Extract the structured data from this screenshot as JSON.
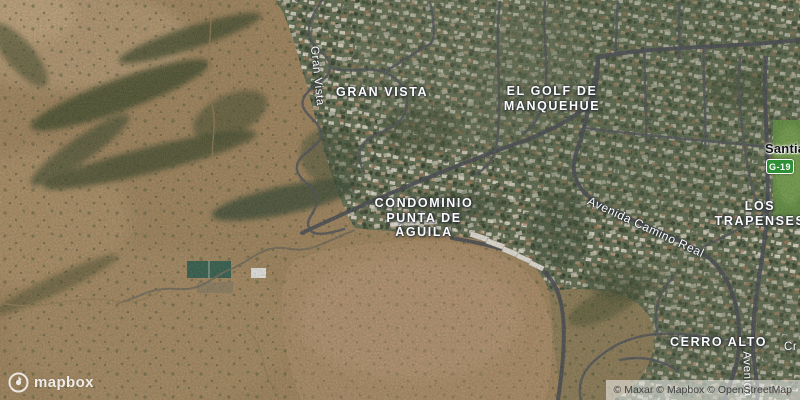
{
  "map": {
    "city_labels": {
      "santiago": "Santiago"
    },
    "place_labels": {
      "gran_vista": "GRAN VISTA",
      "el_golf": {
        "line1": "EL GOLF DE",
        "line2": "MANQUEHUE"
      },
      "condominio": {
        "line1": "CONDOMINIO",
        "line2": "PUNTA DE",
        "line3": "ÁGUILA"
      },
      "los_trapenses": {
        "line1": "LOS",
        "line2": "TRAPENSES"
      },
      "cerro_alto": "CERRO ALTO"
    },
    "street_labels": {
      "gran_vista": "Gran Vista",
      "avenida_camino_real": "Avenida Camino Real",
      "avenida_south": "Avenida",
      "cr_fragment": "Cr"
    },
    "route_shield": {
      "code": "G-19",
      "color": "#2f8f35"
    },
    "imagery_colors": {
      "hills_tan": "#a08257",
      "residential_green": "#5d6a4c",
      "dirt_field": "#ab8a61",
      "road_gray": "#43464b",
      "golf_green": "#5e8c3b"
    }
  },
  "branding": {
    "wordmark": "mapbox"
  },
  "attribution": {
    "text": "© Maxar © Mapbox © OpenStreetMap"
  }
}
